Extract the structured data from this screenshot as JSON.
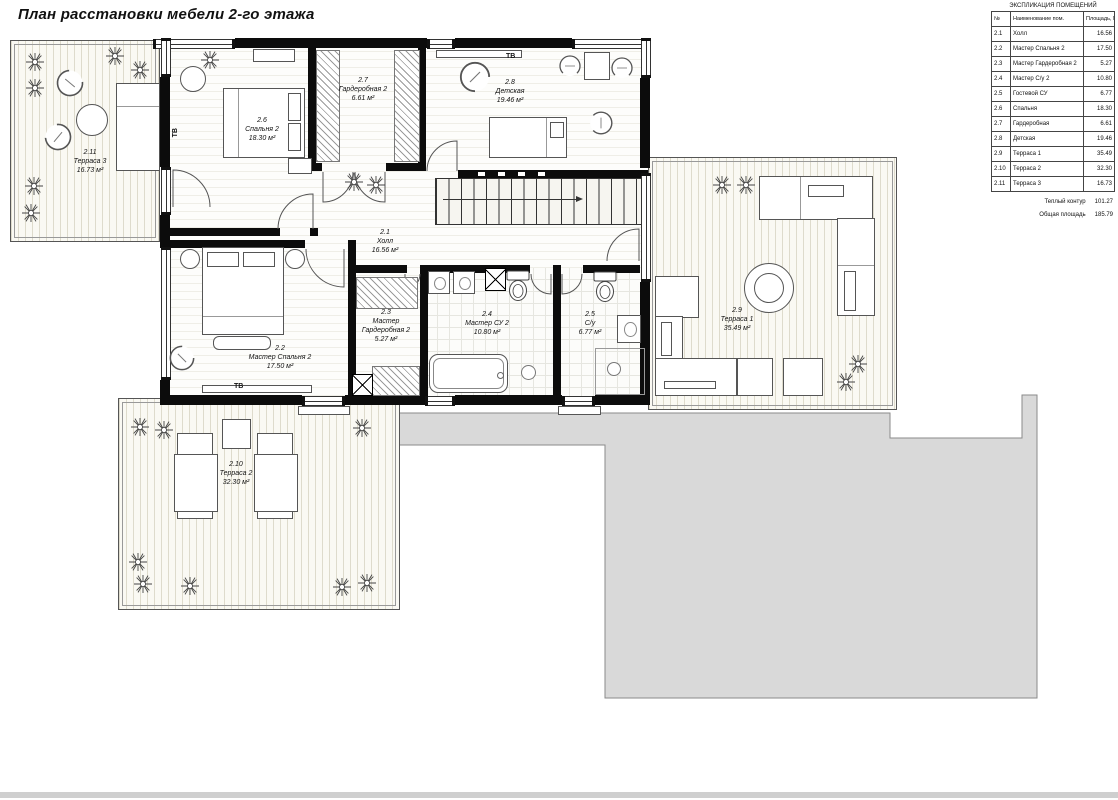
{
  "title": "План расстановки мебели 2-го этажа",
  "explication": {
    "header": "ЭКСПЛИКАЦИЯ ПОМЕЩЕНИЙ",
    "columns": [
      "№",
      "Наименование пом.",
      "Площадь, М2"
    ],
    "rows": [
      {
        "num": "2.1",
        "name": "Холл",
        "area": "16.56"
      },
      {
        "num": "2.2",
        "name": "Мастер Спальня 2",
        "area": "17.50"
      },
      {
        "num": "2.3",
        "name": "Мастер Гардеробная 2",
        "area": "5.27"
      },
      {
        "num": "2.4",
        "name": "Мастер С/у 2",
        "area": "10.80"
      },
      {
        "num": "2.5",
        "name": "Гостевой СУ",
        "area": "6.77"
      },
      {
        "num": "2.6",
        "name": "Спальня",
        "area": "18.30"
      },
      {
        "num": "2.7",
        "name": "Гардеробная",
        "area": "6.61"
      },
      {
        "num": "2.8",
        "name": "Детская",
        "area": "19.46"
      },
      {
        "num": "2.9",
        "name": "Терраса 1",
        "area": "35.49"
      },
      {
        "num": "2.10",
        "name": "Терраса 2",
        "area": "32.30"
      },
      {
        "num": "2.11",
        "name": "Терраса 3",
        "area": "16.73"
      }
    ],
    "totals": [
      {
        "label": "Теплый контур",
        "value": "101.27"
      },
      {
        "label": "Общая площадь",
        "value": "185.79"
      }
    ]
  },
  "rooms": [
    {
      "id": "2.1",
      "name": "Холл",
      "area": "16.56 м²"
    },
    {
      "id": "2.2",
      "name": "Мастер Спальня 2",
      "area": "17.50 м²"
    },
    {
      "id": "2.3",
      "name": "Мастер Гардеробная 2",
      "area": "5.27 м²"
    },
    {
      "id": "2.4",
      "name": "Мастер СУ 2",
      "area": "10.80 м²"
    },
    {
      "id": "2.5",
      "name": "С/у",
      "area": "6.77 м²"
    },
    {
      "id": "2.6",
      "name": "Спальня 2",
      "area": "18.30 м²"
    },
    {
      "id": "2.7",
      "name": "Гардеробная 2",
      "area": "6.61 м²"
    },
    {
      "id": "2.8",
      "name": "Детская",
      "area": "19.46 м²"
    },
    {
      "id": "2.9",
      "name": "Терраса 1",
      "area": "35.49 м²"
    },
    {
      "id": "2.10",
      "name": "Терраса 2",
      "area": "32.30 м²"
    },
    {
      "id": "2.11",
      "name": "Терраса 3",
      "area": "16.73 м²"
    }
  ],
  "annotations": {
    "tv": "ТВ"
  },
  "colors": {
    "wall": "#0c0c0c",
    "roof_gray": "#d9d9d9",
    "deck": "#faf9f3"
  }
}
